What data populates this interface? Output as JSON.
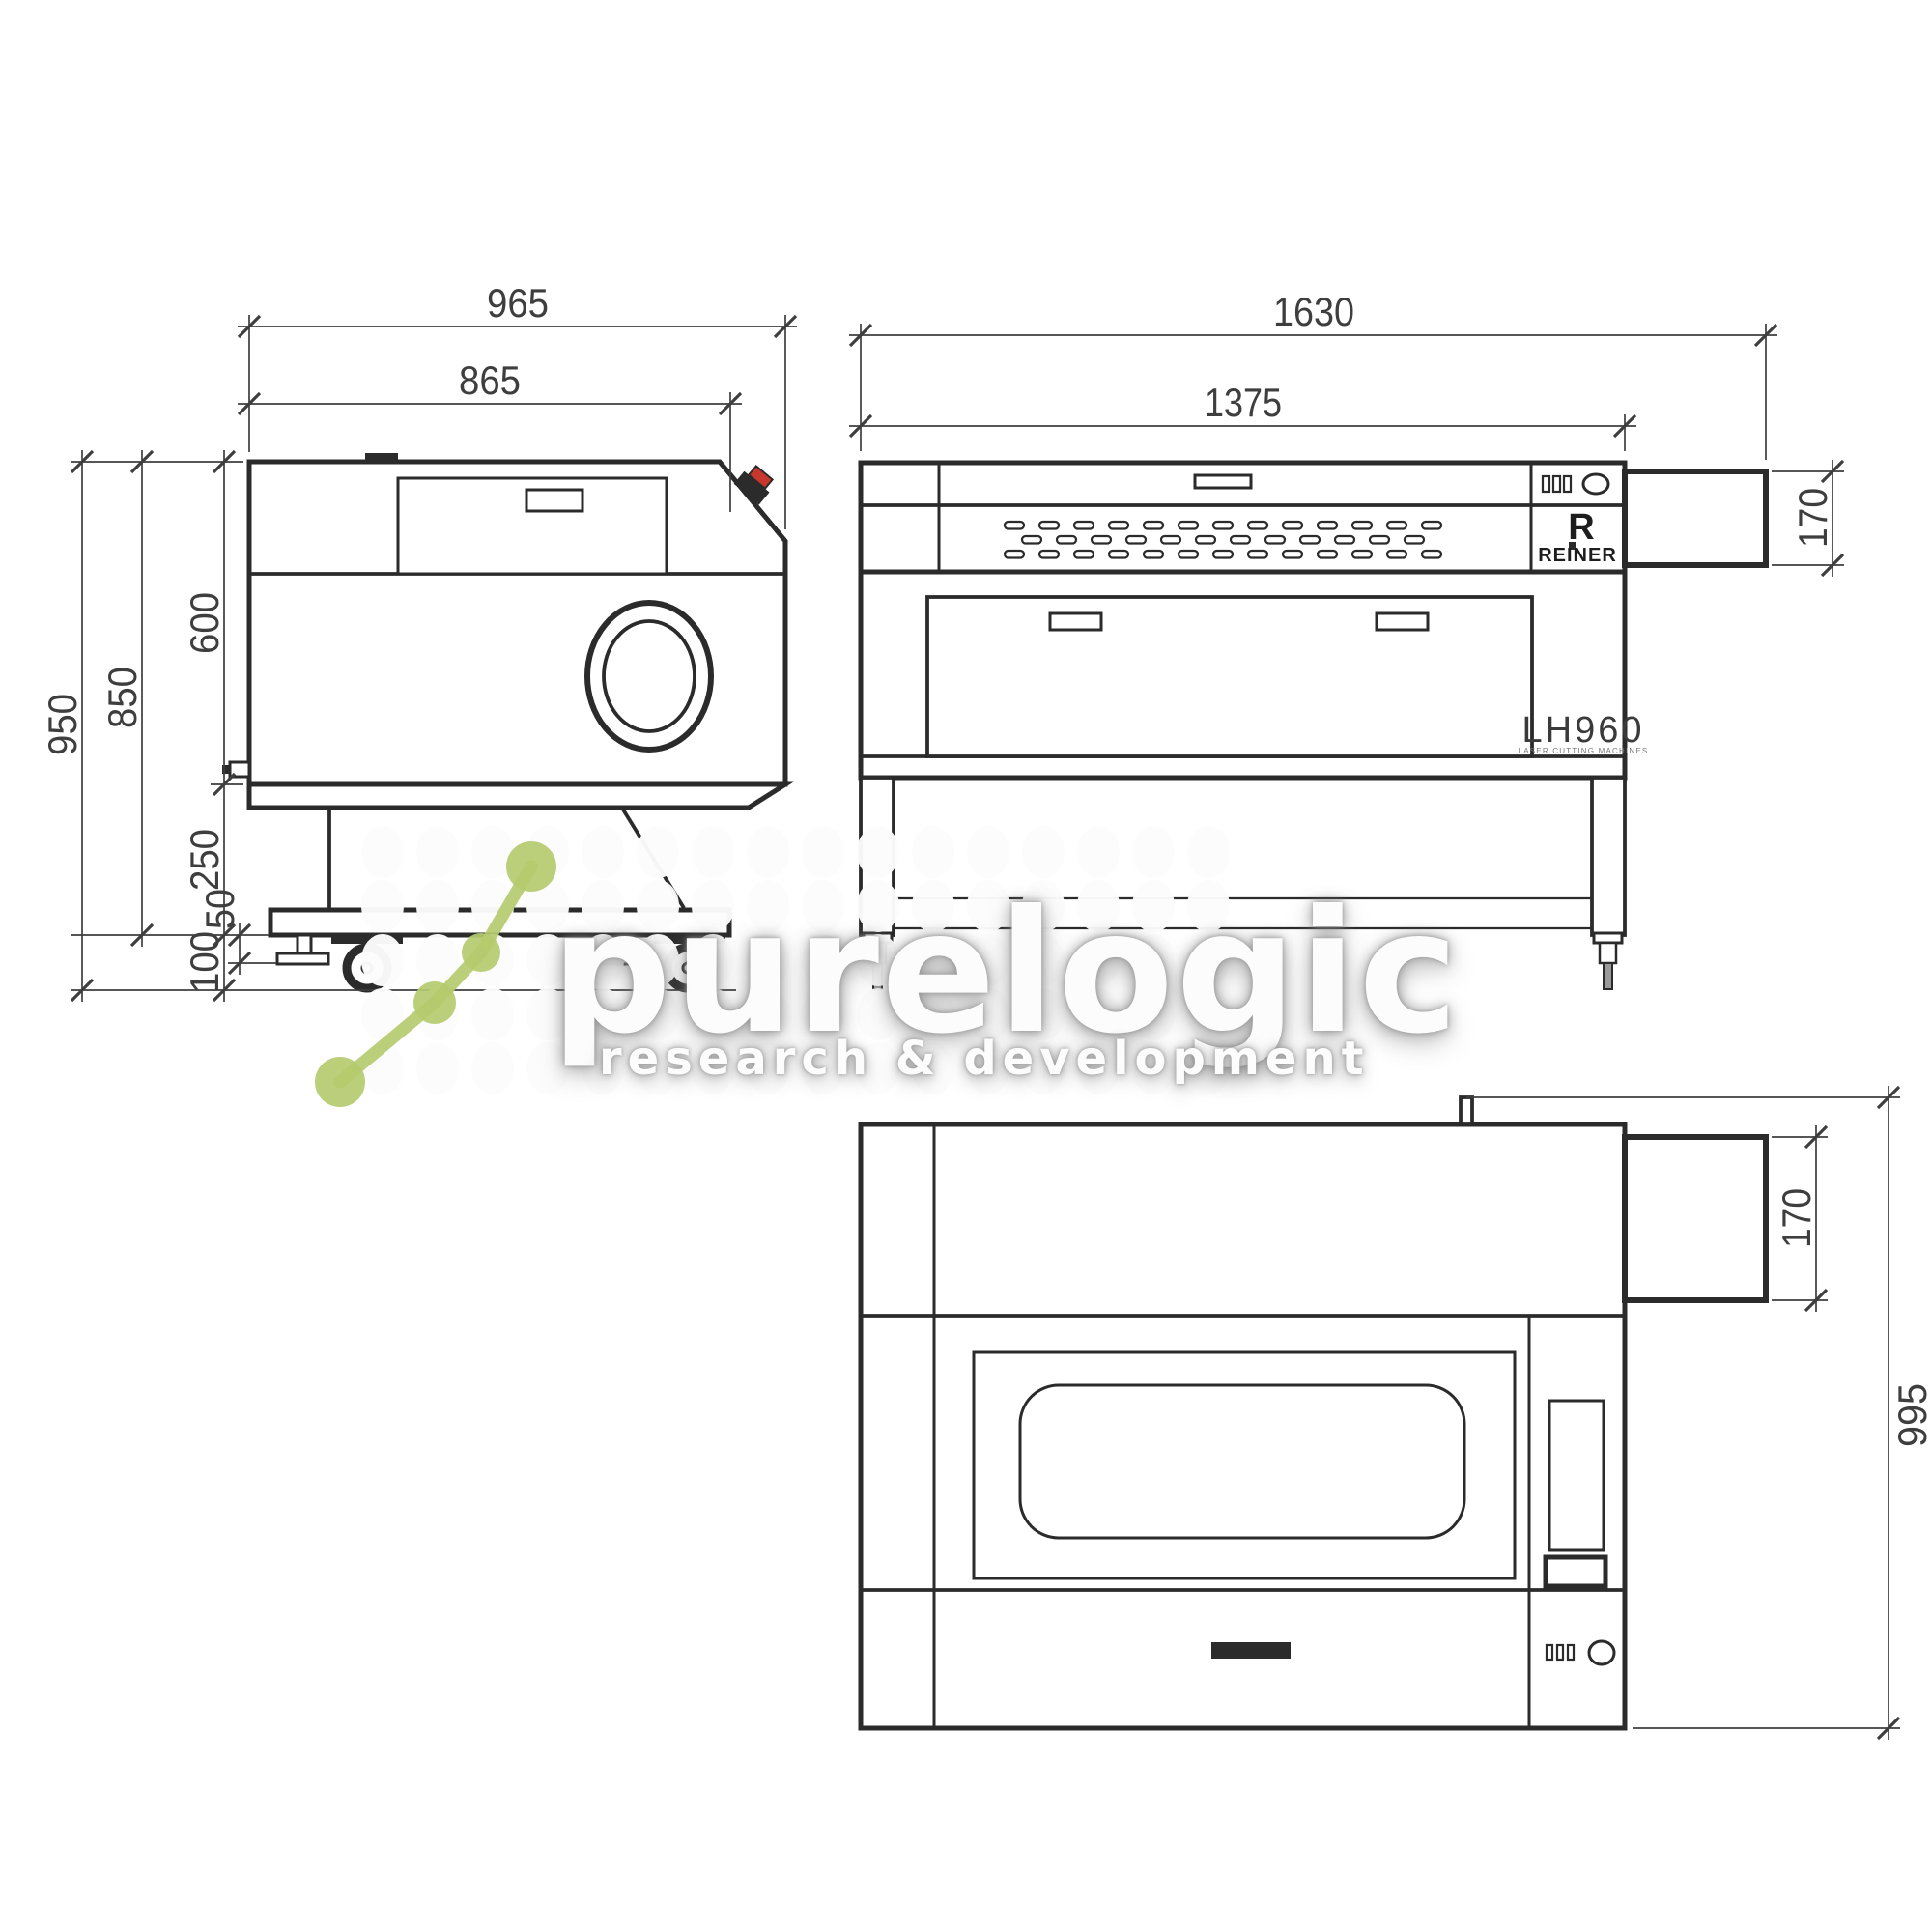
{
  "watermark": {
    "title": "purelogic",
    "subtitle": "research & development",
    "accent_color": "#b5ca6e"
  },
  "brand": {
    "logo_letter": "R",
    "logo_name": "REINER",
    "model": "LH960",
    "model_subtitle": "LASER CUTTING MACHINES"
  },
  "side_view": {
    "dims": {
      "width_total": "965",
      "width_top": "865",
      "height_body": "600",
      "height_to_stand_base": "850",
      "height_total": "950",
      "stand_height": "250",
      "foot_travel": "50",
      "caster_height": "100"
    }
  },
  "front_view": {
    "dims": {
      "width_total": "1630",
      "width_body": "1375",
      "duct_height": "170"
    }
  },
  "top_view": {
    "dims": {
      "duct_depth": "170",
      "depth_total": "995"
    }
  },
  "line_color": "#2b2b2b",
  "emergency_button_color": "#c8372d"
}
